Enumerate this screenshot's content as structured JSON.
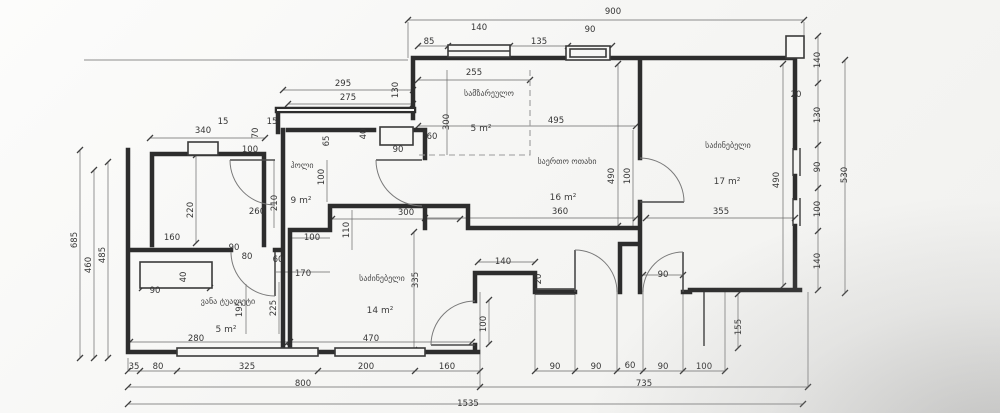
{
  "drawing": {
    "type": "apartment-floor-plan",
    "units": "cm",
    "line_color": "#2d2d2d",
    "paper_color": "#f5f5f3"
  },
  "totals": {
    "top_width": "900",
    "overall_width": "1535",
    "bottom_left_width": "800",
    "bottom_right_width": "735",
    "left_height": "685",
    "right_height": "530"
  },
  "rooms": [
    {
      "label": "სამზარეულო",
      "area": "5 m²",
      "lx": 489,
      "ly": 96,
      "ax": 481,
      "ay": 131
    },
    {
      "label": "საერთო ოთახი",
      "area": "16 m²",
      "lx": 567,
      "ly": 164,
      "ax": 563,
      "ay": 200
    },
    {
      "label": "საძინებელი",
      "area": "17 m²",
      "lx": 728,
      "ly": 148,
      "ax": 727,
      "ay": 184
    },
    {
      "label": "ჰოლი",
      "area": "9 m²",
      "lx": 302,
      "ly": 168,
      "ax": 301,
      "ay": 203
    },
    {
      "label": "საძინებელი",
      "area": "14 m²",
      "lx": 382,
      "ly": 281,
      "ax": 380,
      "ay": 313
    },
    {
      "label": "ვანა ტუალეტი",
      "area": "5 m²",
      "lx": 228,
      "ly": 304,
      "ax": 226,
      "ay": 332
    }
  ],
  "dimension_labels": [
    {
      "v": "900",
      "x": 613,
      "y": 14
    },
    {
      "v": "85",
      "x": 429,
      "y": 44
    },
    {
      "v": "140",
      "x": 479,
      "y": 30
    },
    {
      "v": "135",
      "x": 539,
      "y": 44
    },
    {
      "v": "90",
      "x": 590,
      "y": 32
    },
    {
      "v": "255",
      "x": 474,
      "y": 75
    },
    {
      "v": "295",
      "x": 343,
      "y": 86
    },
    {
      "v": "275",
      "x": 348,
      "y": 100
    },
    {
      "v": "130",
      "x": 398,
      "y": 90,
      "r": 1
    },
    {
      "v": "340",
      "x": 203,
      "y": 133
    },
    {
      "v": "15",
      "x": 223,
      "y": 124
    },
    {
      "v": "70",
      "x": 258,
      "y": 133,
      "r": 1
    },
    {
      "v": "15",
      "x": 272,
      "y": 124
    },
    {
      "v": "100",
      "x": 250,
      "y": 152
    },
    {
      "v": "65",
      "x": 329,
      "y": 141,
      "r": 1
    },
    {
      "v": "40",
      "x": 366,
      "y": 134,
      "r": 1
    },
    {
      "v": "90",
      "x": 398,
      "y": 152
    },
    {
      "v": "60",
      "x": 432,
      "y": 139
    },
    {
      "v": "300",
      "x": 449,
      "y": 122,
      "r": 1
    },
    {
      "v": "495",
      "x": 556,
      "y": 123
    },
    {
      "v": "490",
      "x": 614,
      "y": 176,
      "r": 1
    },
    {
      "v": "100",
      "x": 630,
      "y": 176,
      "r": 1
    },
    {
      "v": "20",
      "x": 796,
      "y": 97
    },
    {
      "v": "490",
      "x": 779,
      "y": 180,
      "r": 1
    },
    {
      "v": "140",
      "x": 820,
      "y": 60,
      "r": 1
    },
    {
      "v": "130",
      "x": 820,
      "y": 115,
      "r": 1
    },
    {
      "v": "90",
      "x": 820,
      "y": 167,
      "r": 1
    },
    {
      "v": "100",
      "x": 820,
      "y": 209,
      "r": 1
    },
    {
      "v": "140",
      "x": 820,
      "y": 261,
      "r": 1
    },
    {
      "v": "530",
      "x": 847,
      "y": 175,
      "r": 1
    },
    {
      "v": "360",
      "x": 560,
      "y": 214
    },
    {
      "v": "355",
      "x": 721,
      "y": 214
    },
    {
      "v": "685",
      "x": 77,
      "y": 240,
      "r": 1
    },
    {
      "v": "460",
      "x": 91,
      "y": 265,
      "r": 1
    },
    {
      "v": "485",
      "x": 105,
      "y": 255,
      "r": 1
    },
    {
      "v": "220",
      "x": 193,
      "y": 210,
      "r": 1
    },
    {
      "v": "160",
      "x": 172,
      "y": 240
    },
    {
      "v": "260",
      "x": 257,
      "y": 214
    },
    {
      "v": "210",
      "x": 277,
      "y": 203,
      "r": 1
    },
    {
      "v": "100",
      "x": 324,
      "y": 177,
      "r": 1
    },
    {
      "v": "110",
      "x": 349,
      "y": 230,
      "r": 1
    },
    {
      "v": "300",
      "x": 406,
      "y": 215
    },
    {
      "v": "100",
      "x": 312,
      "y": 240
    },
    {
      "v": "90",
      "x": 234,
      "y": 250
    },
    {
      "v": "80",
      "x": 247,
      "y": 259
    },
    {
      "v": "60",
      "x": 278,
      "y": 262
    },
    {
      "v": "170",
      "x": 303,
      "y": 276
    },
    {
      "v": "40",
      "x": 186,
      "y": 277,
      "r": 1
    },
    {
      "v": "90",
      "x": 155,
      "y": 293
    },
    {
      "v": "195",
      "x": 242,
      "y": 309,
      "r": 1
    },
    {
      "v": "225",
      "x": 276,
      "y": 308,
      "r": 1
    },
    {
      "v": "335",
      "x": 418,
      "y": 280,
      "r": 1
    },
    {
      "v": "140",
      "x": 503,
      "y": 264
    },
    {
      "v": "20",
      "x": 541,
      "y": 279,
      "r": 1
    },
    {
      "v": "90",
      "x": 663,
      "y": 277
    },
    {
      "v": "100",
      "x": 486,
      "y": 324,
      "r": 1
    },
    {
      "v": "155",
      "x": 741,
      "y": 327,
      "r": 1
    },
    {
      "v": "470",
      "x": 371,
      "y": 341
    },
    {
      "v": "280",
      "x": 196,
      "y": 341
    },
    {
      "v": "35",
      "x": 134,
      "y": 369
    },
    {
      "v": "80",
      "x": 158,
      "y": 369
    },
    {
      "v": "325",
      "x": 247,
      "y": 369
    },
    {
      "v": "200",
      "x": 366,
      "y": 369
    },
    {
      "v": "160",
      "x": 447,
      "y": 369
    },
    {
      "v": "90",
      "x": 555,
      "y": 369
    },
    {
      "v": "90",
      "x": 596,
      "y": 369
    },
    {
      "v": "60",
      "x": 630,
      "y": 368
    },
    {
      "v": "90",
      "x": 663,
      "y": 369
    },
    {
      "v": "100",
      "x": 704,
      "y": 369
    },
    {
      "v": "800",
      "x": 303,
      "y": 386
    },
    {
      "v": "735",
      "x": 644,
      "y": 386
    },
    {
      "v": "1535",
      "x": 468,
      "y": 406
    }
  ]
}
